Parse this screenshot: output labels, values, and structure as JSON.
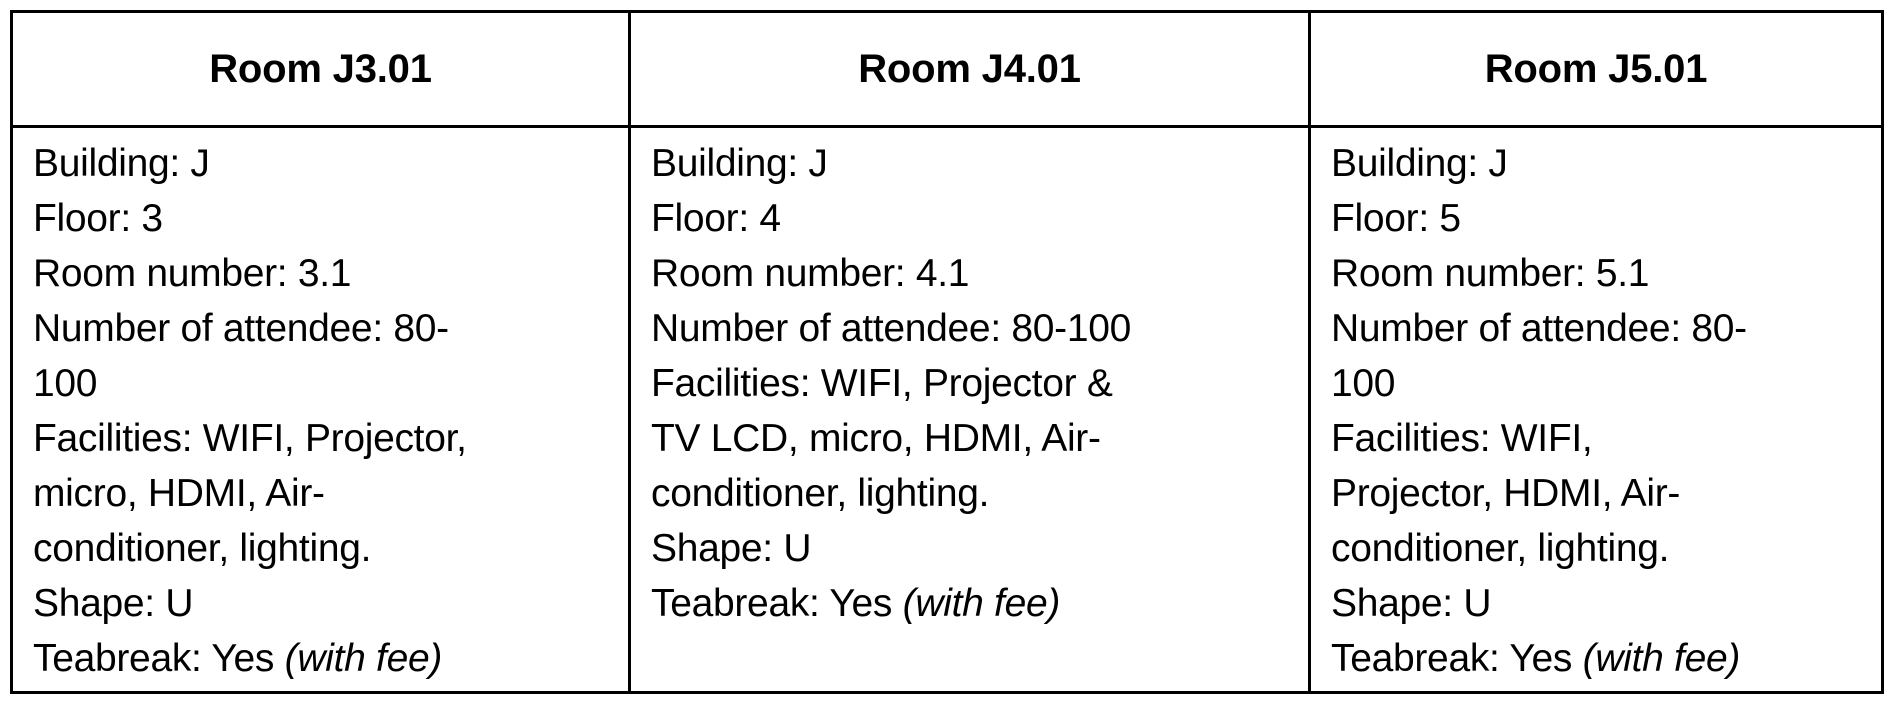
{
  "page": {
    "background_color": "#ffffff",
    "border_color": "#000000",
    "text_color": "#000000"
  },
  "table": {
    "columns": [
      {
        "header": "Room J3.01",
        "body_lines": "Building: J\nFloor: 3\nRoom number: 3.1\nNumber of attendee: 80-\n100\nFacilities: WIFI, Projector,\nmicro, HDMI, Air-\nconditioner, lighting.\nShape: U",
        "teabreak_prefix": "Teabreak: Yes ",
        "teabreak_note": "(with fee)"
      },
      {
        "header": "Room J4.01",
        "body_lines": "Building: J\nFloor: 4\nRoom number: 4.1\nNumber of attendee: 80-100\nFacilities: WIFI, Projector &\nTV LCD, micro, HDMI, Air-\nconditioner, lighting.\nShape: U",
        "teabreak_prefix": "Teabreak: Yes ",
        "teabreak_note": "(with fee)"
      },
      {
        "header": "Room J5.01",
        "body_lines": "Building: J\nFloor: 5\nRoom number: 5.1\nNumber of attendee: 80-\n100\nFacilities: WIFI,\nProjector, HDMI, Air-\nconditioner, lighting.\nShape: U",
        "teabreak_prefix": "Teabreak: Yes ",
        "teabreak_note": "(with fee)"
      }
    ]
  }
}
